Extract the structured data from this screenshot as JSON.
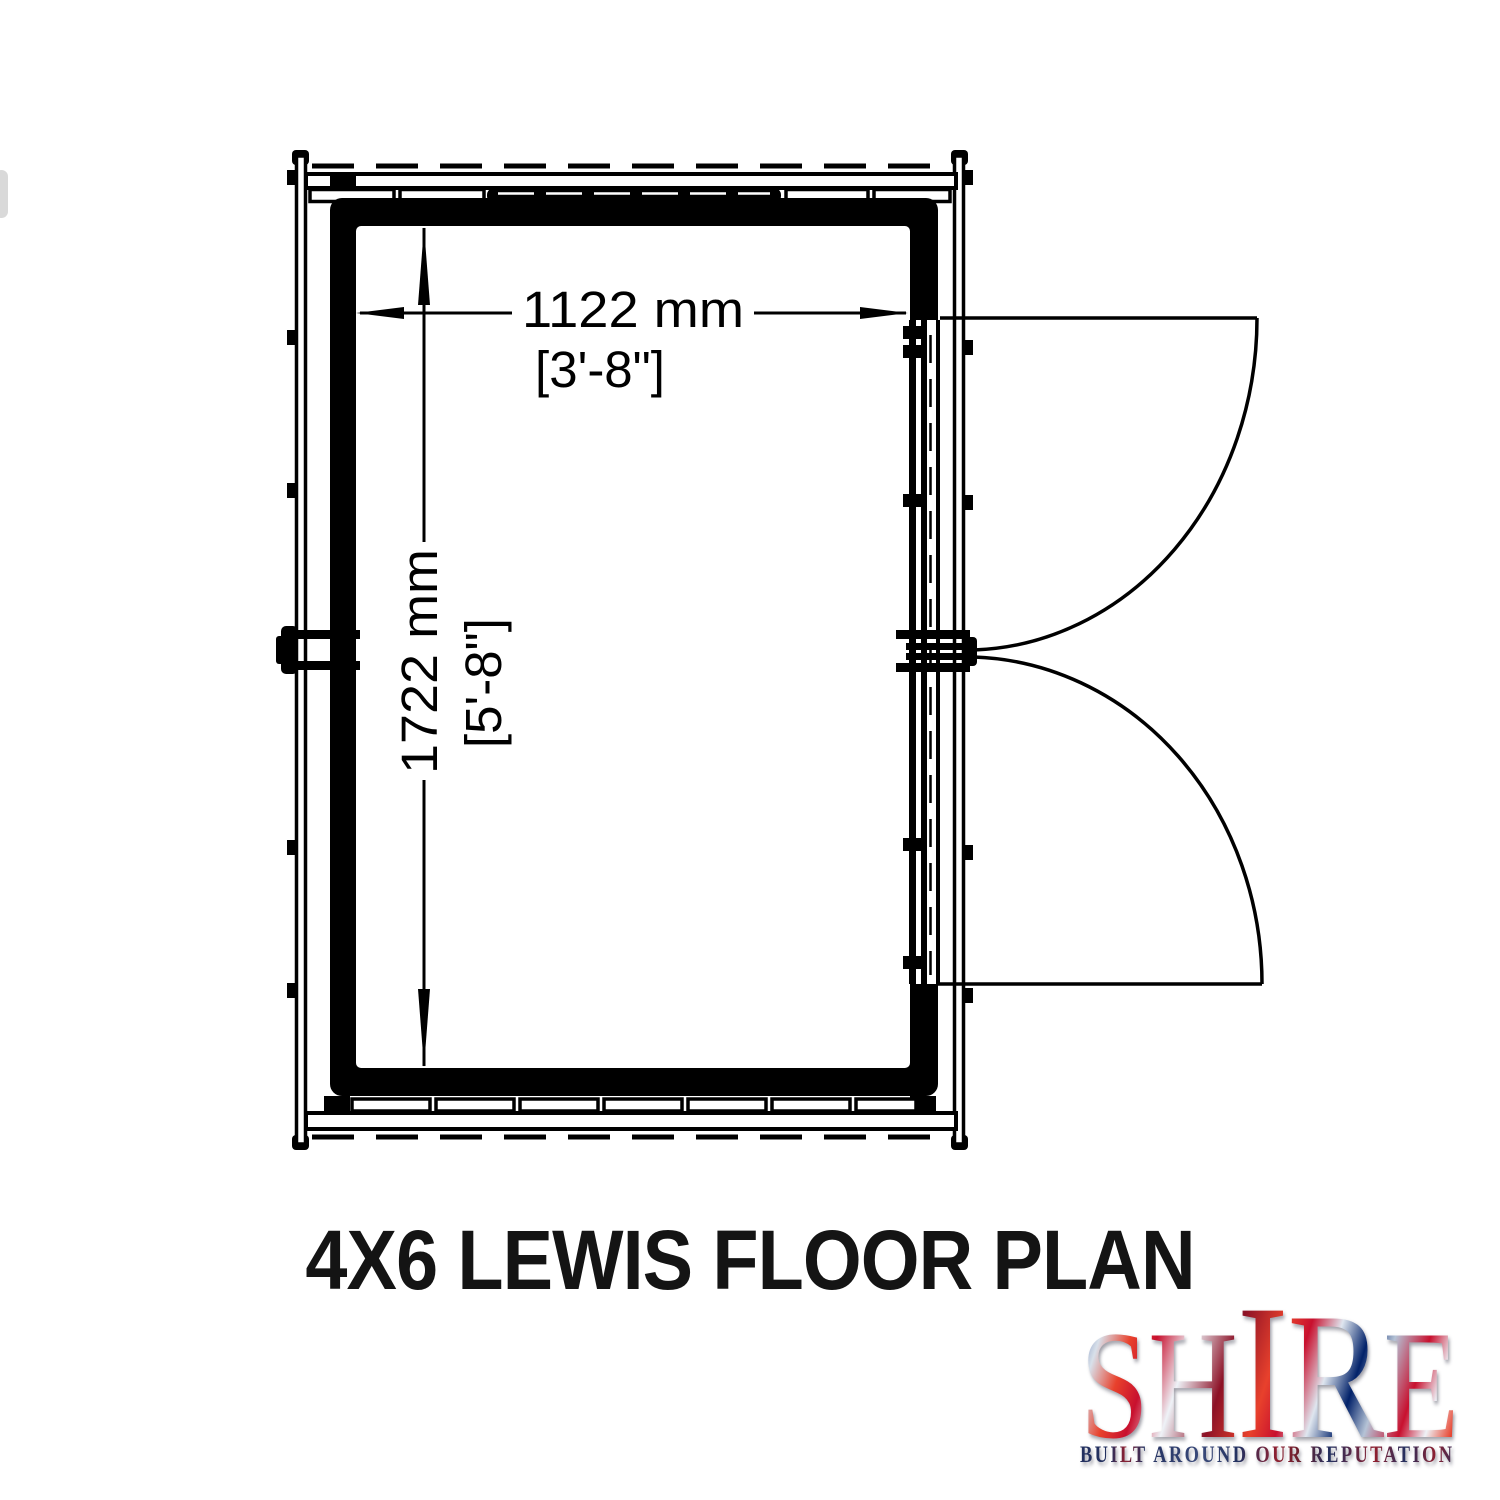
{
  "title": "4X6 LEWIS FLOOR PLAN",
  "drawing": {
    "width_label": "1122 mm",
    "width_label_imperial": "[3'-8\"]",
    "height_label": "1722 mm",
    "height_label_imperial": "[5'-8\"]"
  },
  "logo": {
    "word": "SHIRE",
    "letters": [
      "S",
      "H",
      "I",
      "R",
      "E"
    ],
    "tagline": "BUILT AROUND OUR REPUTATION",
    "colors": {
      "flag_red": "#c8102e",
      "flag_blue": "#012169",
      "tagline_navy": "#23305f",
      "tagline_red": "#8f2030"
    }
  },
  "line_color": "#000000"
}
